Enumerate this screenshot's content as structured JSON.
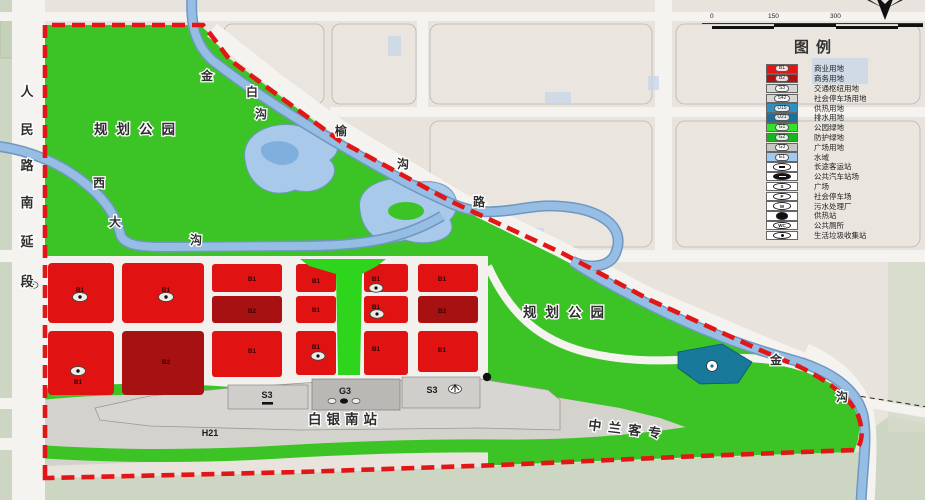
{
  "map": {
    "parks": {
      "park1": "规划公园",
      "park2": "规划公园"
    },
    "station_label": "白银南站",
    "railway_label": "中兰客专",
    "h21": "H21",
    "codes": {
      "b1": "B1",
      "b2": "B2",
      "s3": "S3",
      "g3": "G3"
    },
    "roads": {
      "renmin": [
        "人",
        "民",
        "路",
        "南",
        "延",
        "段"
      ],
      "yugou": [
        "榆",
        "沟",
        "路"
      ],
      "jinbaigou": [
        "金",
        "白",
        "沟"
      ],
      "xidagou": [
        "西",
        "大",
        "沟"
      ],
      "jingou": [
        "金",
        "沟"
      ]
    },
    "colors": {
      "park_green": "#3cc426",
      "boundary_red": "#e21616",
      "water_blue": "#96bde4",
      "commercial_red": "#e01212",
      "business_darkred": "#a81111",
      "drainage_teal": "#19799a"
    }
  },
  "legend": {
    "title": "图例",
    "items": [
      {
        "code": "B1",
        "label": "商业用地",
        "color": "#e31515"
      },
      {
        "code": "B2",
        "label": "商务用地",
        "color": "#b21111"
      },
      {
        "code": "S3",
        "label": "交通枢纽用地",
        "color": "#d6d6d6"
      },
      {
        "code": "S42",
        "label": "社会停车场用地",
        "color": "#d6d6d6"
      },
      {
        "code": "U15",
        "label": "供热用地",
        "color": "#2e8fc0"
      },
      {
        "code": "U21",
        "label": "排水用地",
        "color": "#1d6f9a"
      },
      {
        "code": "G1",
        "label": "公园绿地",
        "color": "#35e02c"
      },
      {
        "code": "G2",
        "label": "防护绿地",
        "color": "#17b520"
      },
      {
        "code": "G3",
        "label": "广场用地",
        "color": "#c6c6c6"
      },
      {
        "code": "E1",
        "label": "水域",
        "color": "#a0cbf0"
      }
    ],
    "icon_items": [
      {
        "label": "长途客运站",
        "symbol": "",
        "glyph": "bus-outline-icon"
      },
      {
        "label": "公共汽车站场",
        "symbol": "",
        "glyph": "bus-filled-icon"
      },
      {
        "label": "广场",
        "symbol": "S",
        "glyph": "letter-badge"
      },
      {
        "label": "社会停车场",
        "symbol": "P",
        "glyph": "letter-badge"
      },
      {
        "label": "污水处理厂",
        "symbol": "W",
        "glyph": "letter-badge"
      },
      {
        "label": "供热站",
        "symbol": "",
        "glyph": "heat-blob-icon"
      },
      {
        "label": "公共厕所",
        "symbol": "WC",
        "glyph": "letter-badge"
      },
      {
        "label": "生活垃圾收集站",
        "symbol": "",
        "glyph": "dot-badge-icon"
      }
    ]
  },
  "scalebar": {
    "ticks": [
      "0",
      "150",
      "300"
    ]
  }
}
